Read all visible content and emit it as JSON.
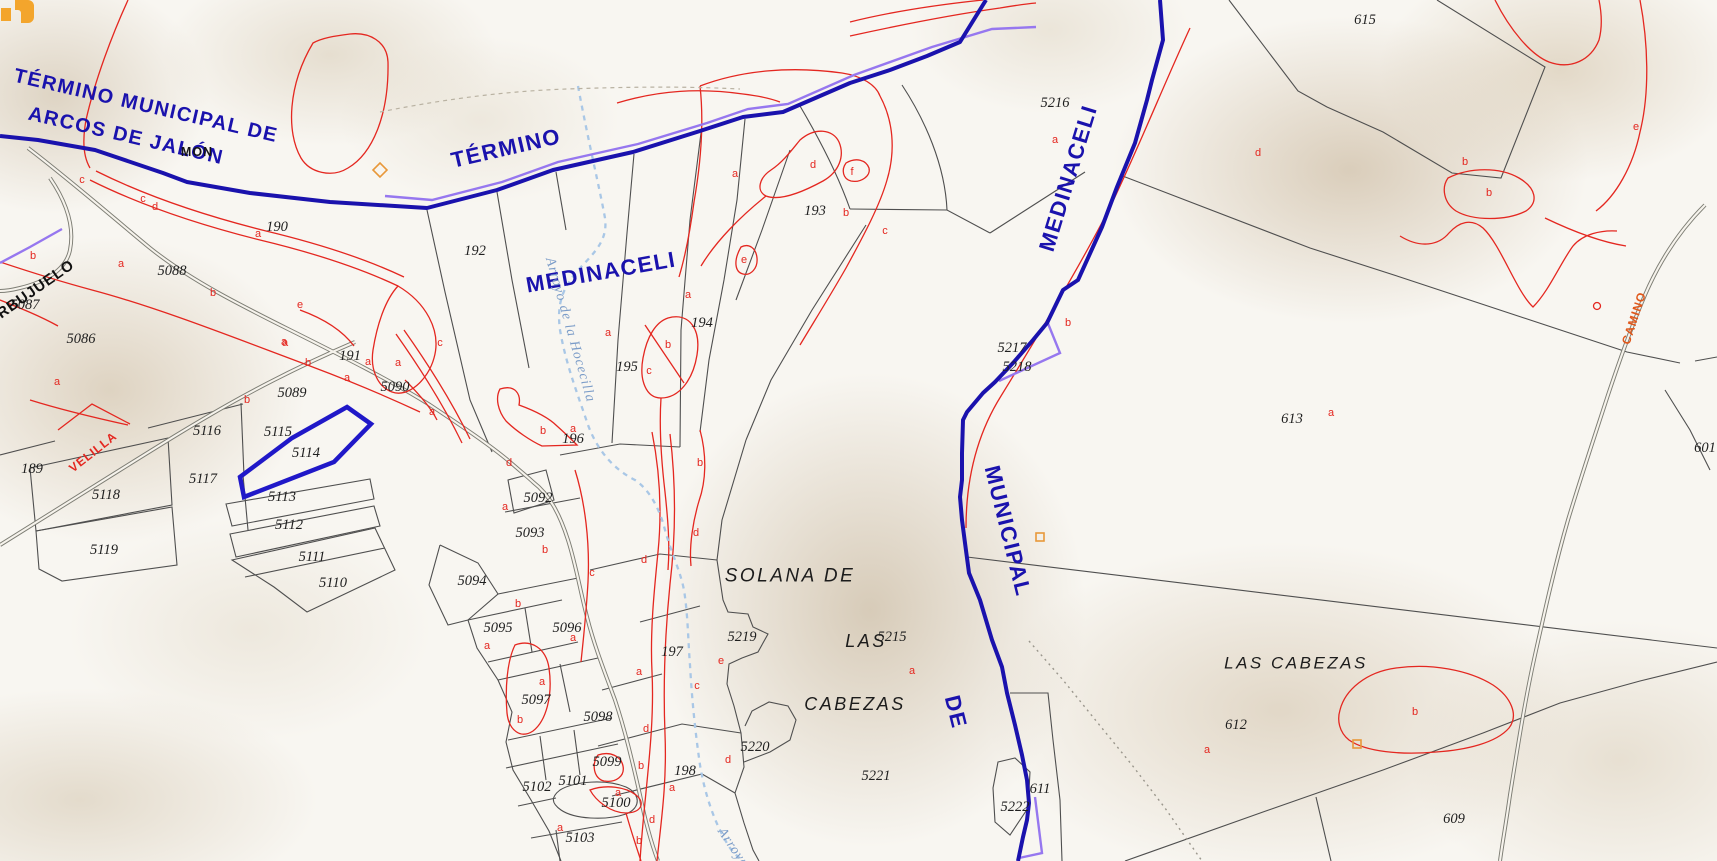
{
  "canvas": {
    "width": 1717,
    "height": 861
  },
  "colors": {
    "municipal_boundary": "#1a12ad",
    "parcel_line": "#4f4f4f",
    "subparcel_line": "#e42720",
    "selection": "#2018c8",
    "stream": "#a9c7e6",
    "violet_overlay": "#9677ef",
    "road_label_red": "#e42720",
    "road_label_orange": "#e0571a",
    "background": "#f8f6f1",
    "logo_orange": "#f3a52c"
  },
  "selected_parcel": {
    "id": "5114",
    "points": "347,407 371,424 334,462 244,497 240,477 292,438"
  },
  "labels": {
    "municipality": [
      {
        "text": "TÉRMINO MUNICIPAL DE",
        "x": 146,
        "y": 106,
        "rot": 13,
        "size": 20
      },
      {
        "text": "ARCOS DE JALÓN",
        "x": 126,
        "y": 136,
        "rot": 13,
        "size": 20
      },
      {
        "text": "TÉRMINO",
        "x": 506,
        "y": 148,
        "rot": -13,
        "size": 22
      },
      {
        "text": "MEDINACELI",
        "x": 601,
        "y": 272,
        "rot": -10,
        "size": 22
      },
      {
        "text": "MEDINACELI",
        "x": 1068,
        "y": 178,
        "rot": -73,
        "size": 22
      },
      {
        "text": "MUNICIPAL",
        "x": 1008,
        "y": 531,
        "rot": 76,
        "size": 22
      },
      {
        "text": "DE",
        "x": 956,
        "y": 712,
        "rot": 76,
        "size": 22
      }
    ],
    "places": [
      {
        "text": "SOLANA DE",
        "x": 790,
        "y": 576
      },
      {
        "text": "LAS",
        "x": 866,
        "y": 641,
        "size": 18
      },
      {
        "text": "CABEZAS",
        "x": 855,
        "y": 704,
        "size": 18
      },
      {
        "text": "LAS CABEZAS",
        "x": 1296,
        "y": 663,
        "size": 17
      },
      {
        "text": "BARBUJUELO",
        "x": 26,
        "y": 296,
        "rot": -35,
        "cls": "lbl-barbujuelo"
      }
    ],
    "roads": [
      {
        "text": "VELILLA",
        "x": 93,
        "y": 452,
        "rot": -38,
        "color": "#e42720"
      },
      {
        "text": "CAMINO",
        "x": 1634,
        "y": 318,
        "rot": -72,
        "color": "#e0571a"
      }
    ],
    "streams": [
      {
        "text": "Arroyo de la Hocecilla",
        "x": 570,
        "y": 330,
        "rot": 74
      },
      {
        "text": "Arroyo",
        "x": 733,
        "y": 848,
        "rot": 56
      }
    ],
    "misc": [
      {
        "text": "MON",
        "x": 197,
        "y": 152
      }
    ],
    "parcels": [
      {
        "text": "189",
        "x": 32,
        "y": 469
      },
      {
        "text": "190",
        "x": 277,
        "y": 227
      },
      {
        "text": "191",
        "x": 350,
        "y": 356
      },
      {
        "text": "192",
        "x": 475,
        "y": 251
      },
      {
        "text": "193",
        "x": 815,
        "y": 211
      },
      {
        "text": "194",
        "x": 702,
        "y": 323
      },
      {
        "text": "195",
        "x": 627,
        "y": 367
      },
      {
        "text": "196",
        "x": 573,
        "y": 439
      },
      {
        "text": "197",
        "x": 672,
        "y": 652
      },
      {
        "text": "198",
        "x": 685,
        "y": 771
      },
      {
        "text": "5086",
        "x": 81,
        "y": 339
      },
      {
        "text": "5087",
        "x": 25,
        "y": 305
      },
      {
        "text": "5088",
        "x": 172,
        "y": 271
      },
      {
        "text": "5089",
        "x": 292,
        "y": 393
      },
      {
        "text": "5090",
        "x": 395,
        "y": 387
      },
      {
        "text": "5092",
        "x": 538,
        "y": 498
      },
      {
        "text": "5093",
        "x": 530,
        "y": 533
      },
      {
        "text": "5094",
        "x": 472,
        "y": 581
      },
      {
        "text": "5095",
        "x": 498,
        "y": 628
      },
      {
        "text": "5096",
        "x": 567,
        "y": 628
      },
      {
        "text": "5097",
        "x": 536,
        "y": 700
      },
      {
        "text": "5098",
        "x": 598,
        "y": 717
      },
      {
        "text": "5099",
        "x": 607,
        "y": 762
      },
      {
        "text": "5100",
        "x": 616,
        "y": 803
      },
      {
        "text": "5101",
        "x": 573,
        "y": 781
      },
      {
        "text": "5102",
        "x": 537,
        "y": 787
      },
      {
        "text": "5103",
        "x": 580,
        "y": 838
      },
      {
        "text": "5110",
        "x": 333,
        "y": 583
      },
      {
        "text": "5111",
        "x": 312,
        "y": 557
      },
      {
        "text": "5112",
        "x": 289,
        "y": 525
      },
      {
        "text": "5113",
        "x": 282,
        "y": 497
      },
      {
        "text": "5114",
        "x": 306,
        "y": 453
      },
      {
        "text": "5115",
        "x": 278,
        "y": 432
      },
      {
        "text": "5116",
        "x": 207,
        "y": 431
      },
      {
        "text": "5117",
        "x": 203,
        "y": 479
      },
      {
        "text": "5118",
        "x": 106,
        "y": 495
      },
      {
        "text": "5119",
        "x": 104,
        "y": 550
      },
      {
        "text": "5215",
        "x": 892,
        "y": 637
      },
      {
        "text": "5216",
        "x": 1055,
        "y": 103
      },
      {
        "text": "5217",
        "x": 1012,
        "y": 348
      },
      {
        "text": "5218",
        "x": 1017,
        "y": 367
      },
      {
        "text": "5219",
        "x": 742,
        "y": 637
      },
      {
        "text": "5220",
        "x": 755,
        "y": 747
      },
      {
        "text": "5221",
        "x": 876,
        "y": 776
      },
      {
        "text": "5222",
        "x": 1015,
        "y": 807
      },
      {
        "text": "601",
        "x": 1705,
        "y": 448
      },
      {
        "text": "609",
        "x": 1454,
        "y": 819
      },
      {
        "text": "611",
        "x": 1040,
        "y": 789
      },
      {
        "text": "612",
        "x": 1236,
        "y": 725
      },
      {
        "text": "613",
        "x": 1292,
        "y": 419
      },
      {
        "text": "615",
        "x": 1365,
        "y": 20
      }
    ],
    "letters": [
      {
        "text": "c",
        "x": 82,
        "y": 180
      },
      {
        "text": "c",
        "x": 143,
        "y": 199
      },
      {
        "text": "d",
        "x": 155,
        "y": 207
      },
      {
        "text": "b",
        "x": 33,
        "y": 256
      },
      {
        "text": "a",
        "x": 121,
        "y": 264
      },
      {
        "text": "a",
        "x": 258,
        "y": 234
      },
      {
        "text": "b",
        "x": 213,
        "y": 293
      },
      {
        "text": "a",
        "x": 284,
        "y": 342
      },
      {
        "text": "a",
        "x": 57,
        "y": 382
      },
      {
        "text": "b",
        "x": 247,
        "y": 400
      },
      {
        "text": "e",
        "x": 300,
        "y": 305
      },
      {
        "text": "a",
        "x": 285,
        "y": 343
      },
      {
        "text": "b",
        "x": 308,
        "y": 363
      },
      {
        "text": "a",
        "x": 347,
        "y": 378
      },
      {
        "text": "a",
        "x": 368,
        "y": 362
      },
      {
        "text": "a",
        "x": 398,
        "y": 363
      },
      {
        "text": "c",
        "x": 440,
        "y": 343
      },
      {
        "text": "a",
        "x": 432,
        "y": 412
      },
      {
        "text": "a",
        "x": 735,
        "y": 174
      },
      {
        "text": "d",
        "x": 813,
        "y": 165
      },
      {
        "text": "f",
        "x": 852,
        "y": 172
      },
      {
        "text": "b",
        "x": 846,
        "y": 213
      },
      {
        "text": "e",
        "x": 744,
        "y": 260
      },
      {
        "text": "c",
        "x": 885,
        "y": 231
      },
      {
        "text": "a",
        "x": 688,
        "y": 295
      },
      {
        "text": "a",
        "x": 608,
        "y": 333
      },
      {
        "text": "b",
        "x": 668,
        "y": 345
      },
      {
        "text": "c",
        "x": 649,
        "y": 371
      },
      {
        "text": "b",
        "x": 543,
        "y": 431
      },
      {
        "text": "a",
        "x": 573,
        "y": 429
      },
      {
        "text": "a",
        "x": 1055,
        "y": 140
      },
      {
        "text": "d",
        "x": 1258,
        "y": 153
      },
      {
        "text": "b",
        "x": 1465,
        "y": 162
      },
      {
        "text": "b",
        "x": 1489,
        "y": 193
      },
      {
        "text": "e",
        "x": 1636,
        "y": 127
      },
      {
        "text": "d",
        "x": 509,
        "y": 463
      },
      {
        "text": "a",
        "x": 505,
        "y": 507
      },
      {
        "text": "b",
        "x": 545,
        "y": 550
      },
      {
        "text": "c",
        "x": 592,
        "y": 573
      },
      {
        "text": "b",
        "x": 518,
        "y": 604
      },
      {
        "text": "a",
        "x": 573,
        "y": 638
      },
      {
        "text": "a",
        "x": 487,
        "y": 646
      },
      {
        "text": "b",
        "x": 700,
        "y": 463
      },
      {
        "text": "d",
        "x": 696,
        "y": 533
      },
      {
        "text": "d",
        "x": 644,
        "y": 560
      },
      {
        "text": "a",
        "x": 542,
        "y": 682
      },
      {
        "text": "b",
        "x": 520,
        "y": 720
      },
      {
        "text": "a",
        "x": 639,
        "y": 672
      },
      {
        "text": "d",
        "x": 646,
        "y": 729
      },
      {
        "text": "b",
        "x": 641,
        "y": 766
      },
      {
        "text": "a",
        "x": 618,
        "y": 793
      },
      {
        "text": "a",
        "x": 672,
        "y": 788
      },
      {
        "text": "d",
        "x": 652,
        "y": 820
      },
      {
        "text": "a",
        "x": 560,
        "y": 828
      },
      {
        "text": "b",
        "x": 639,
        "y": 841
      },
      {
        "text": "c",
        "x": 697,
        "y": 686
      },
      {
        "text": "e",
        "x": 721,
        "y": 661
      },
      {
        "text": "d",
        "x": 728,
        "y": 760
      },
      {
        "text": "a",
        "x": 912,
        "y": 671
      },
      {
        "text": "b",
        "x": 1068,
        "y": 323
      },
      {
        "text": "a",
        "x": 1331,
        "y": 413
      },
      {
        "text": "b",
        "x": 1415,
        "y": 712
      },
      {
        "text": "a",
        "x": 1207,
        "y": 750
      }
    ]
  }
}
